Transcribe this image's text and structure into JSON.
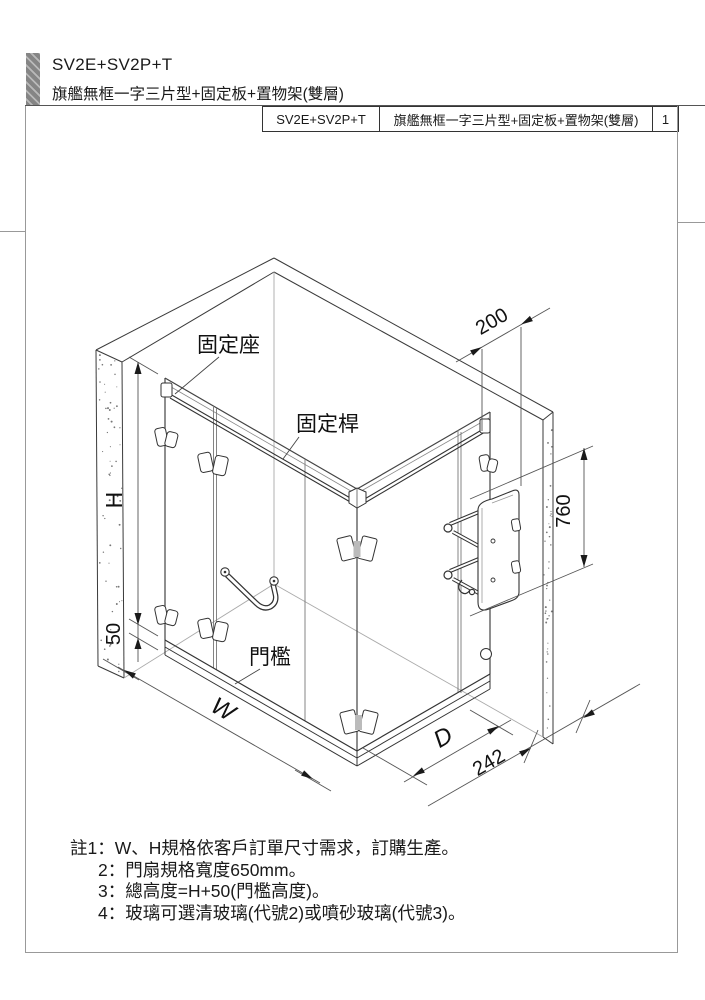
{
  "header": {
    "model": "SV2E+SV2P+T",
    "subtitle": "旗艦無框一字三片型+固定板+置物架(雙層)"
  },
  "title_block": {
    "model": "SV2E+SV2P+T",
    "description": "旗艦無框一字三片型+固定板+置物架(雙層)",
    "page": "1"
  },
  "drawing": {
    "labels": {
      "fixed_seat": "固定座",
      "fixed_bar": "固定桿",
      "threshold": "門檻"
    },
    "dimensions": {
      "height": "H",
      "threshold_height": "50",
      "width": "W",
      "depth": "D",
      "wall_gap": "242",
      "shelf_offset": "200",
      "shelf_height": "760"
    }
  },
  "notes": {
    "lines": [
      "註1：W、H規格依客戶訂單尺寸需求，訂購生產。",
      "2：門扇規格寬度650mm。",
      "3：總高度=H+50(門檻高度)。",
      "4：玻璃可選清玻璃(代號2)或噴砂玻璃(代號3)。"
    ]
  },
  "colors": {
    "outline": "#3a3a3a",
    "dim_line": "#555",
    "page_border": "#999"
  }
}
